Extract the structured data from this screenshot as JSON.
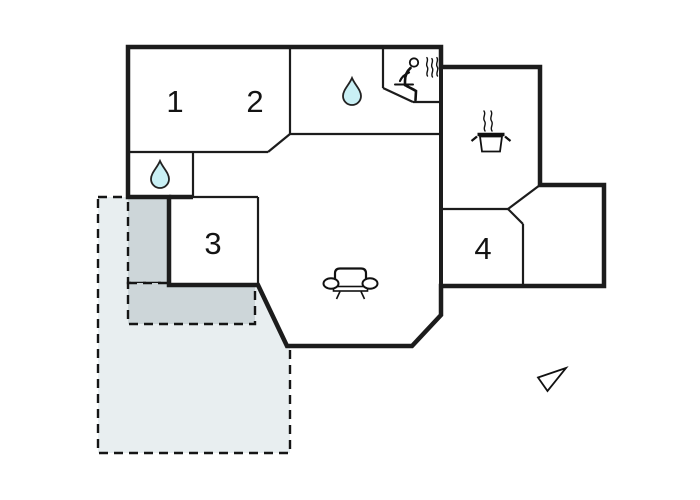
{
  "floorplan": {
    "type": "holiday-home floor plan",
    "rooms": [
      {
        "label": "1"
      },
      {
        "label": "2"
      },
      {
        "label": "3"
      },
      {
        "label": "4"
      }
    ],
    "icons": [
      "water-drop-icon (top bathroom)",
      "water-drop-icon (left bathroom)",
      "sauna-person-icon",
      "cooking-pot-icon (kitchen)",
      "sofa-icon (living room)",
      "north-arrow-icon"
    ],
    "areas": {
      "terrace_light_label": "",
      "terrace_dark_label": ""
    },
    "colors": {
      "wall": "#1c1c1c",
      "terrace_light": "#e8eef0",
      "terrace_dark": "#cdd6d9",
      "water_drop": "#c9f0f5",
      "background": "#ffffff"
    }
  }
}
